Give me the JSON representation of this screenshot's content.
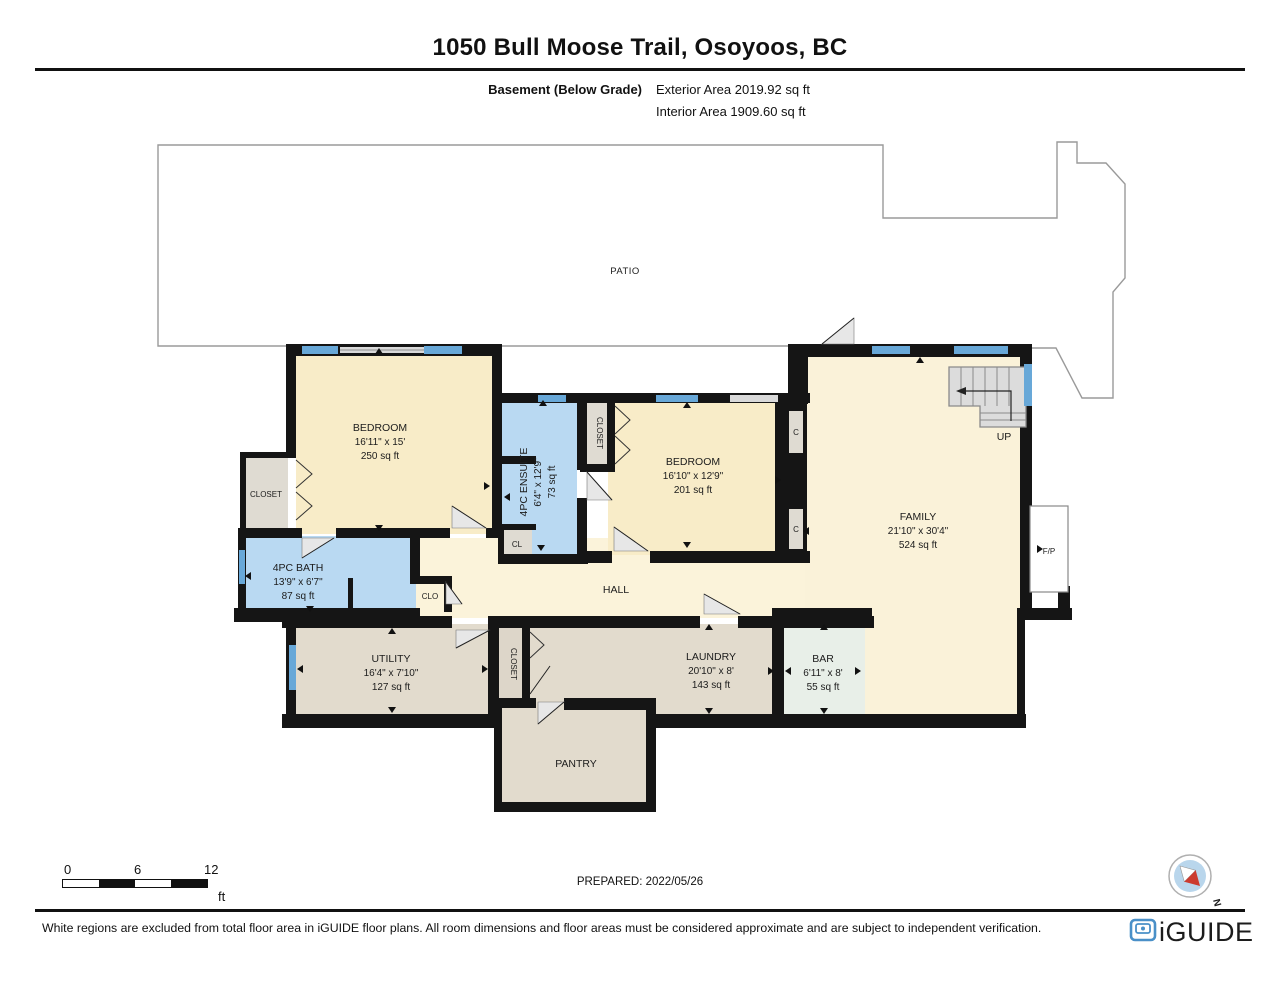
{
  "header": {
    "title": "1050 Bull Moose Trail, Osoyoos, BC",
    "floor_label": "Basement (Below Grade)",
    "exterior_area": "Exterior Area 2019.92 sq ft",
    "interior_area": "Interior Area 1909.60 sq ft"
  },
  "plan": {
    "patio_label": "PATIO",
    "rooms": [
      {
        "name": "BEDROOM",
        "dims": "16'11\" x 15'",
        "area": "250 sq ft"
      },
      {
        "name": "4PC ENSUITE",
        "dims": "6'4\" x 12'9\"",
        "area": "73 sq ft"
      },
      {
        "name": "BEDROOM",
        "dims": "16'10\" x 12'9\"",
        "area": "201 sq ft"
      },
      {
        "name": "FAMILY",
        "dims": "21'10\" x 30'4\"",
        "area": "524 sq ft"
      },
      {
        "name": "4PC BATH",
        "dims": "13'9\" x 6'7\"",
        "area": "87 sq ft"
      },
      {
        "name": "UTILITY",
        "dims": "16'4\" x 7'10\"",
        "area": "127 sq ft"
      },
      {
        "name": "LAUNDRY",
        "dims": "20'10\" x 8'",
        "area": "143 sq ft"
      },
      {
        "name": "BAR",
        "dims": "6'11\" x 8'",
        "area": "55 sq ft"
      }
    ],
    "labels": {
      "hall": "HALL",
      "pantry": "PANTRY",
      "closet": "CLOSET",
      "closet2": "CLOSET",
      "closet3": "CLOSET",
      "cl": "CL",
      "clo": "CLO",
      "c_upper": "C",
      "c_lower": "C",
      "up": "UP",
      "fp": "F/P"
    }
  },
  "scale_bar": {
    "ticks": [
      "0",
      "6",
      "12"
    ],
    "unit": "ft"
  },
  "prepared": "PREPARED: 2022/05/26",
  "compass": {
    "label": "N"
  },
  "footer": {
    "disclaimer": "White regions are excluded from total floor area in iGUIDE floor plans. All room dimensions and floor areas must be considered approximate and are subject to independent verification.",
    "brand": "iGUIDE"
  },
  "colors": {
    "room_cream": "#f8ecc8",
    "room_cream_light": "#faf2d9",
    "room_blue": "#b9d9f2",
    "room_tan": "#e2dbcd",
    "room_bar_green": "#e8efe8",
    "closet_gray": "#dfdbd2",
    "window_blue": "#68a8d8",
    "wall_black": "#151515",
    "brand_blue": "#4a90c8",
    "compass_red": "#cc3b2f"
  }
}
